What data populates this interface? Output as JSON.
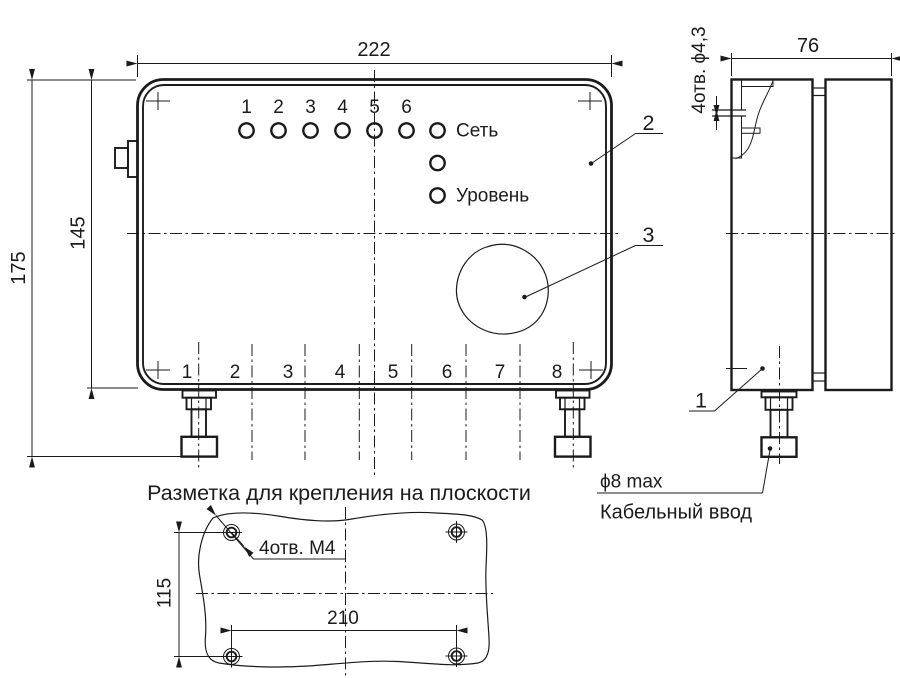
{
  "front_view": {
    "dim_width": "222",
    "dim_height_total": "175",
    "dim_height_body": "145",
    "led_numbers": [
      "1",
      "2",
      "3",
      "4",
      "5",
      "6"
    ],
    "label_power": "Сеть",
    "label_level": "Уровень",
    "terminal_numbers": [
      "1",
      "2",
      "3",
      "4",
      "5",
      "6",
      "7",
      "8"
    ],
    "callout_cover": "2",
    "callout_speaker": "3"
  },
  "side_view": {
    "dim_depth": "76",
    "label_mount_holes": "4отв. ϕ4,3",
    "callout_body": "1",
    "label_cable_dia": "ϕ8 max",
    "label_cable_entry": "Кабельный ввод"
  },
  "mounting_view": {
    "title": "Разметка для крепления на плоскости",
    "label_holes": "4отв. М4",
    "dim_height": "115",
    "dim_width": "210"
  },
  "colors": {
    "ink": "#1b1b1b",
    "background": "#ffffff"
  }
}
